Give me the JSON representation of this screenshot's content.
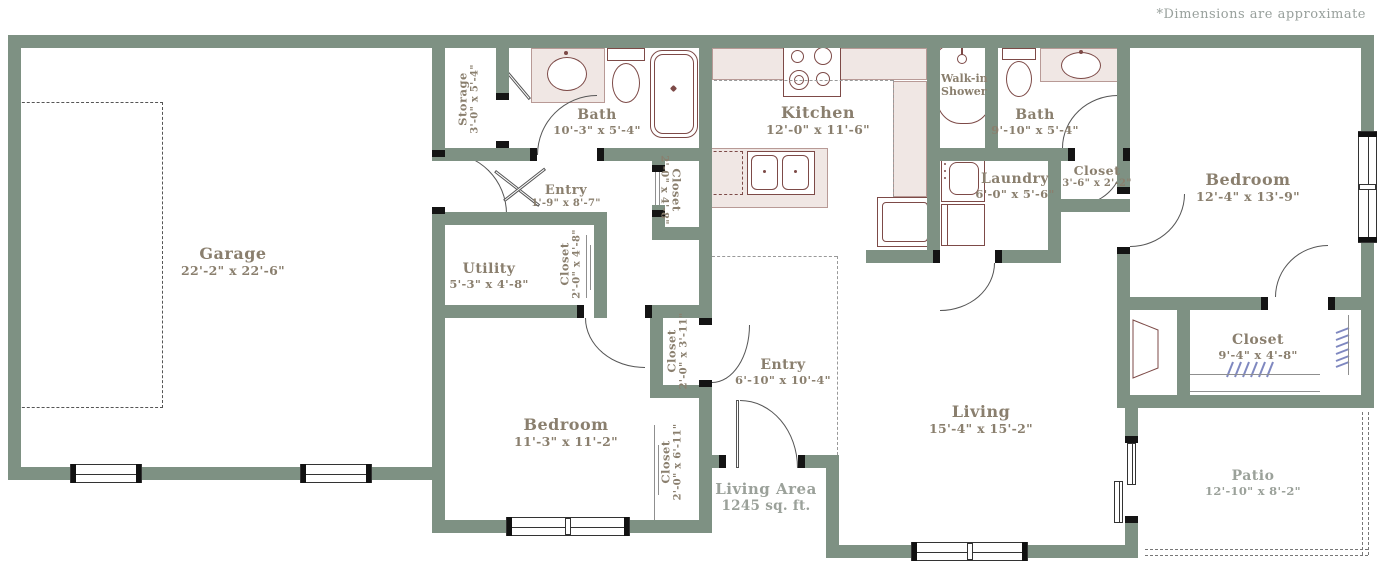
{
  "note": "*Dimensions are approximate",
  "area": {
    "label": "Living Area",
    "value": "1245 sq. ft."
  },
  "rooms": [
    {
      "id": "garage",
      "name": "Garage",
      "dims": "22'-2\" x 22'-6\""
    },
    {
      "id": "storage",
      "name": "Storage",
      "dims": "3'-0\" x 5'-4\""
    },
    {
      "id": "bath-1",
      "name": "Bath",
      "dims": "10'-3\" x 5'-4\""
    },
    {
      "id": "kitchen",
      "name": "Kitchen",
      "dims": "12'-0\" x 11'-6\""
    },
    {
      "id": "walkin-shower",
      "name": "Walk-in Shower",
      "dims": ""
    },
    {
      "id": "bath-2",
      "name": "Bath",
      "dims": "9'-10\" x 5'-4\""
    },
    {
      "id": "bedroom-1",
      "name": "Bedroom",
      "dims": "12'-4\" x 13'-9\""
    },
    {
      "id": "entry-hall",
      "name": "Entry",
      "dims": "1'-9\" x 8'-7\""
    },
    {
      "id": "closet-a",
      "name": "Closet",
      "dims": "2'-0\" x 4'-8\""
    },
    {
      "id": "laundry",
      "name": "Laundry",
      "dims": "6'-0\" x 5'-6\""
    },
    {
      "id": "closet-36",
      "name": "Closet",
      "dims": "3'-6\" x 2'-2\""
    },
    {
      "id": "utility",
      "name": "Utility",
      "dims": "5'-3\" x 4'-8\""
    },
    {
      "id": "closet-b",
      "name": "Closet",
      "dims": "2'-0\" x 4'-8\""
    },
    {
      "id": "closet-c",
      "name": "Closet",
      "dims": "2'-0\" x 3'-11\""
    },
    {
      "id": "entry-main",
      "name": "Entry",
      "dims": "6'-10\" x 10'-4\""
    },
    {
      "id": "closet-94",
      "name": "Closet",
      "dims": "9'-4\" x 4'-8\""
    },
    {
      "id": "bedroom-2",
      "name": "Bedroom",
      "dims": "11'-3\" x 11'-2\""
    },
    {
      "id": "closet-d",
      "name": "Closet",
      "dims": "2'-0\" x 6'-11\""
    },
    {
      "id": "living",
      "name": "Living",
      "dims": "15'-4\" x 15'-2\""
    },
    {
      "id": "patio",
      "name": "Patio",
      "dims": "12'-10\" x 8'-2\""
    }
  ],
  "colors": {
    "wall": "#7e9183",
    "fixture": "#7d4a47",
    "counter": "#f0e7e4",
    "label": "#8a7f6e",
    "label_light": "#9ba19a",
    "hanger": "#7f88c0"
  }
}
